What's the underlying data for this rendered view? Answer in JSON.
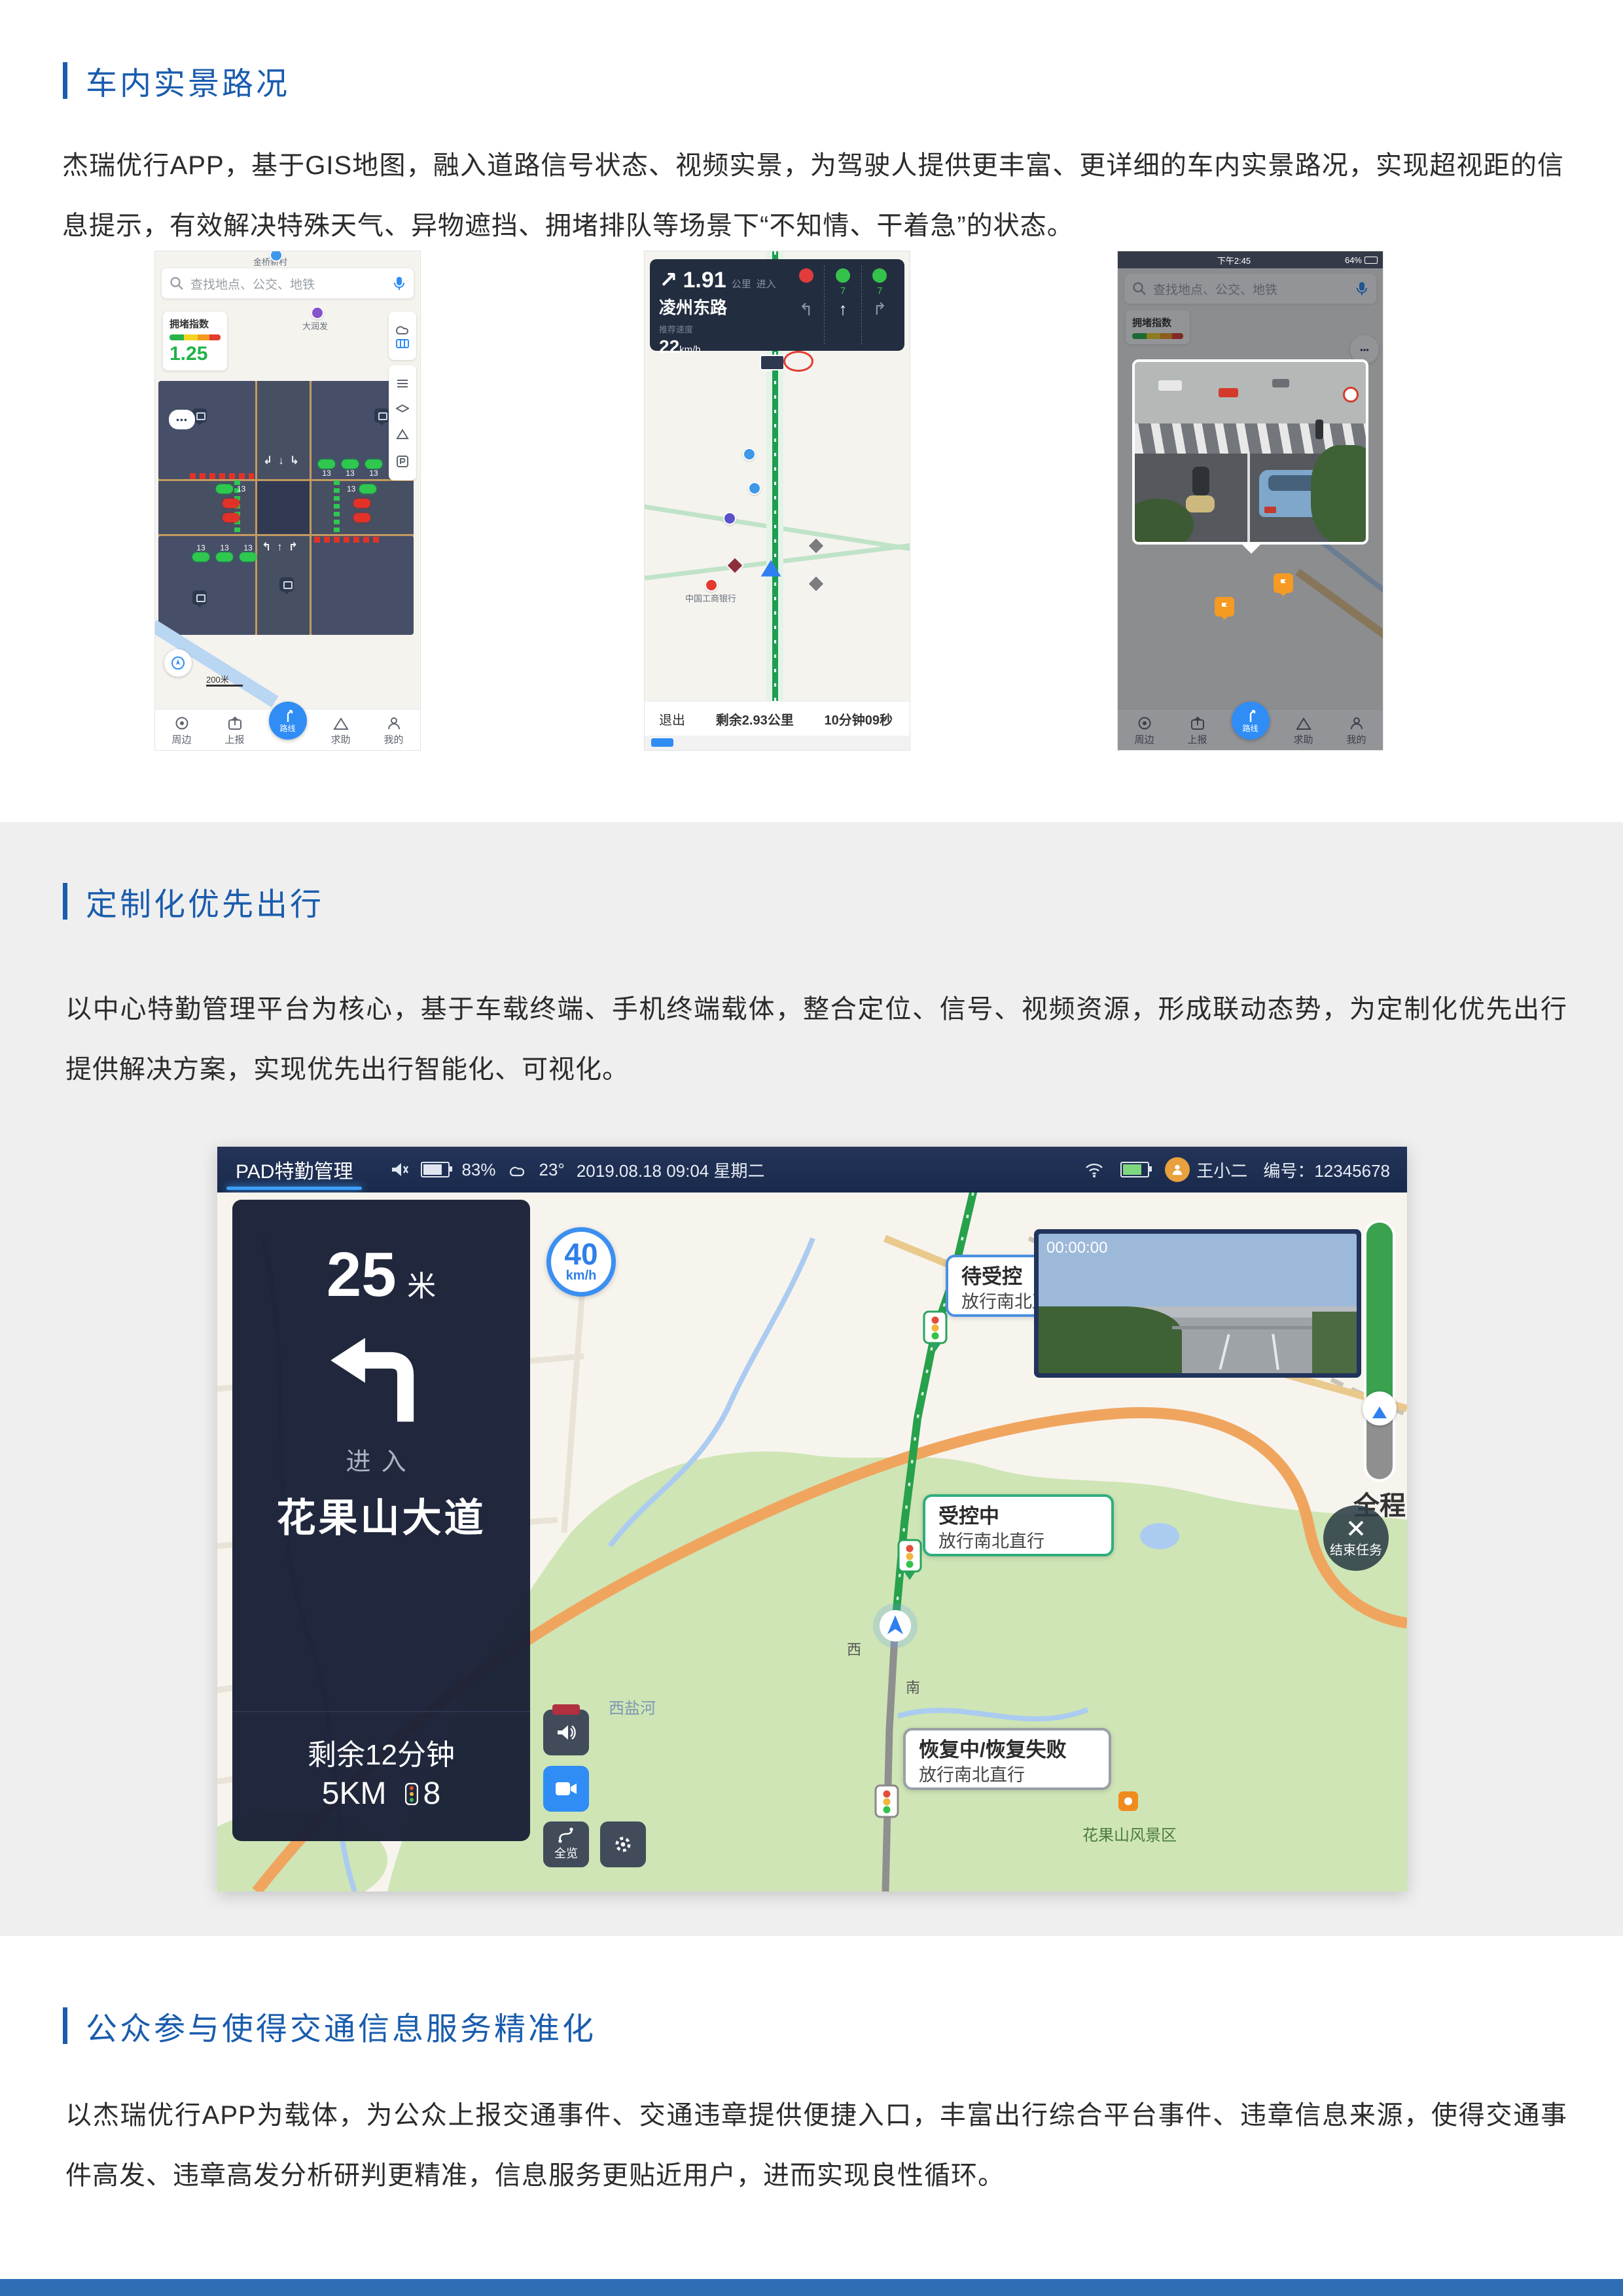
{
  "colors": {
    "accent_blue": "#1a5cad",
    "band_gray": "#efefef",
    "footer_blue": "#2f6db5",
    "route_green": "#27a14b",
    "pad_navy": "#1a2a4c"
  },
  "section1": {
    "title": "车内实景路况",
    "body": "杰瑞优行APP，基于GIS地图，融入道路信号状态、视频实景，为驾驶人提供更丰富、更详细的车内实景路况，实现超视距的信息提示，有效解决特殊天气、异物遮挡、拥堵排队等场景下“不知情、干着急”的状态。"
  },
  "section2": {
    "title": "定制化优先出行",
    "body": "以中心特勤管理平台为核心，基于车载终端、手机终端载体，整合定位、信号、视频资源，形成联动态势，为定制化优先出行提供解决方案，实现优先出行智能化、可视化。"
  },
  "section3": {
    "title": "公众参与使得交通信息服务精准化",
    "body": "以杰瑞优行APP为载体，为公众上报交通事件、交通违章提供便捷入口，丰富出行综合平台事件、违章信息来源，使得交通事件高发、违章高发分析研判更精准，信息服务更贴近用户，进而实现良性循环。"
  },
  "app_nav": [
    "周边",
    "上报",
    "路线",
    "求助",
    "我的"
  ],
  "phone1": {
    "search_placeholder": "查找地点、公交、地铁",
    "congestion_label": "拥堵指数",
    "congestion_value": "1.25",
    "countdown": "13",
    "label_top": "金桥新村",
    "label_store": "大润发",
    "scale": "200米"
  },
  "phone2": {
    "turn_distance": "1.91",
    "distance_unit": "公里",
    "enter": "进入",
    "road": "凌州东路",
    "speed_label": "推荐速度",
    "speed_value": "22",
    "speed_unit": "km/h",
    "countdown_straight": "7",
    "countdown_right": "7",
    "arrow_left": "↰",
    "arrow_straight": "↑",
    "arrow_right": "↱",
    "exit": "退出",
    "remaining": "剩余2.93公里",
    "eta": "10分钟09秒",
    "poi_bank": "中国工商银行"
  },
  "phone3": {
    "status_time": "下午2:45",
    "battery": "64%",
    "search_placeholder": "查找地点、公交、地铁",
    "congestion_label": "拥堵指数"
  },
  "pad": {
    "tab": "PAD特勤管理",
    "battery": "83%",
    "temperature": "23°",
    "datetime": "2019.08.18  09:04  星期二",
    "user": "王小二",
    "user_code": "编号：12345678",
    "speed_limit": "40",
    "speed_limit_unit": "km/h",
    "nav": {
      "distance": "25",
      "distance_unit": "米",
      "enter": "进入",
      "road": "花果山大道",
      "time_remaining": "剩余12分钟",
      "distance_remaining": "5KM",
      "lights_remaining": "8"
    },
    "video_timestamp": "00:00:00",
    "bubbles": [
      {
        "title": "待受控",
        "subtitle": "放行南北直行"
      },
      {
        "title": "受控中",
        "subtitle": "放行南北直行"
      },
      {
        "title": "恢复中/恢复失败",
        "subtitle": "放行南北直行"
      }
    ],
    "progress_label": "全程",
    "end_task": "结束任务",
    "overview_label": "全览",
    "map_labels": {
      "river": "西盐河",
      "scenic": "花果山风景区",
      "west": "西",
      "south": "南"
    }
  }
}
